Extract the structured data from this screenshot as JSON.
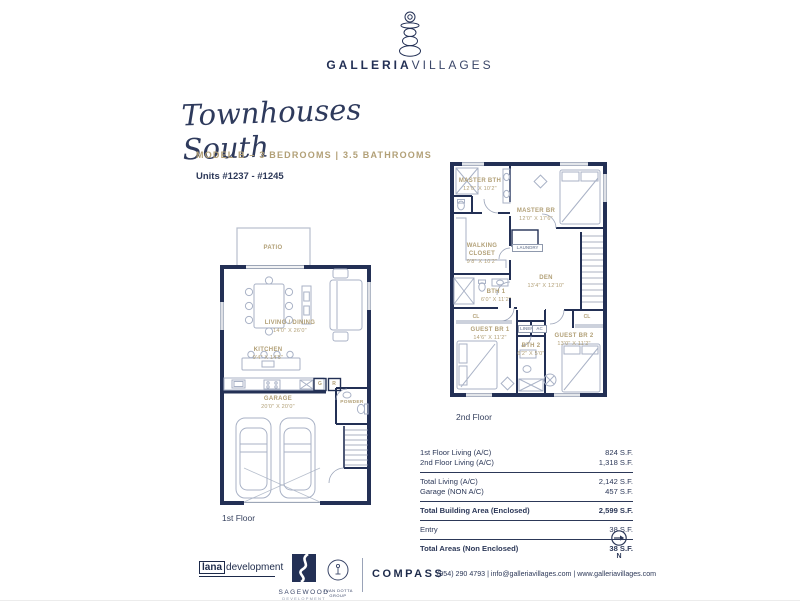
{
  "brand": {
    "name_left": "GALLERIA",
    "name_right": "VILLAGES"
  },
  "header": {
    "script_title": "Townhouses South",
    "model_line": "MODEL B – 3 BEDROOMS | 3.5 BATHROOMS",
    "units_line": "Units #1237 - #1245"
  },
  "floor1": {
    "caption": "1st Floor",
    "rooms": [
      {
        "name": "PATIO",
        "dims": ""
      },
      {
        "name": "LIVING / DINING",
        "dims": "14'0\" X 26'0\""
      },
      {
        "name": "KITCHEN",
        "dims": "9'4\" X 14'5\""
      },
      {
        "name": "POWDER",
        "dims": ""
      },
      {
        "name": "GARAGE",
        "dims": "20'0\" X 20'0\""
      }
    ],
    "tags": [
      {
        "label": "G"
      },
      {
        "label": "R"
      }
    ]
  },
  "floor2": {
    "caption": "2nd Floor",
    "rooms": [
      {
        "name": "MASTER BTH",
        "dims": "12'0\" X 10'2\""
      },
      {
        "name": "MASTER BR",
        "dims": "12'0\" X 17'6\""
      },
      {
        "name": "WALKING CLOSET",
        "dims": "9'8\" X 10'2\""
      },
      {
        "name": "LAUNDRY",
        "dims": ""
      },
      {
        "name": "DEN",
        "dims": "13'4\" X 12'10\""
      },
      {
        "name": "BTH 1",
        "dims": "6'0\" X 11'2\""
      },
      {
        "name": "GUEST BR 1",
        "dims": "14'6\" X 11'2\""
      },
      {
        "name": "BTH 2",
        "dims": "6'2\" X 5'0\""
      },
      {
        "name": "GUEST BR 2",
        "dims": "13'0\" X 11'2\""
      }
    ],
    "tags": [
      {
        "label": "CL"
      },
      {
        "label": "LINEN"
      },
      {
        "label": "AC"
      },
      {
        "label": "CL"
      }
    ]
  },
  "areas": {
    "rows": [
      {
        "label": "1st Floor Living (A/C)",
        "value": "824 S.F."
      },
      {
        "label": "2nd Floor Living (A/C)",
        "value": "1,318 S.F."
      },
      {
        "label": "Total Living (A/C)",
        "value": "2,142 S.F."
      },
      {
        "label": "Garage (NON A/C)",
        "value": "457 S.F."
      },
      {
        "label": "Total Building Area (Enclosed)",
        "value": "2,599 S.F."
      },
      {
        "label": "Entry",
        "value": "38 S.F."
      },
      {
        "label": "Total Areas (Non Enclosed)",
        "value": "38 S.F."
      }
    ]
  },
  "compass": {
    "label": "N"
  },
  "footer": {
    "lana_box": "lana",
    "lana_rest": "development",
    "sagewood_name": "SAGEWOOD",
    "sagewood_sub": "DEVELOPMENT",
    "juan_sub": "JUAN DOTTA GROUP",
    "compass_brand": "COMPASS",
    "contact": "(954) 290 4793  |  info@galleriavillages.com  |  www.galleriavillages.com"
  }
}
